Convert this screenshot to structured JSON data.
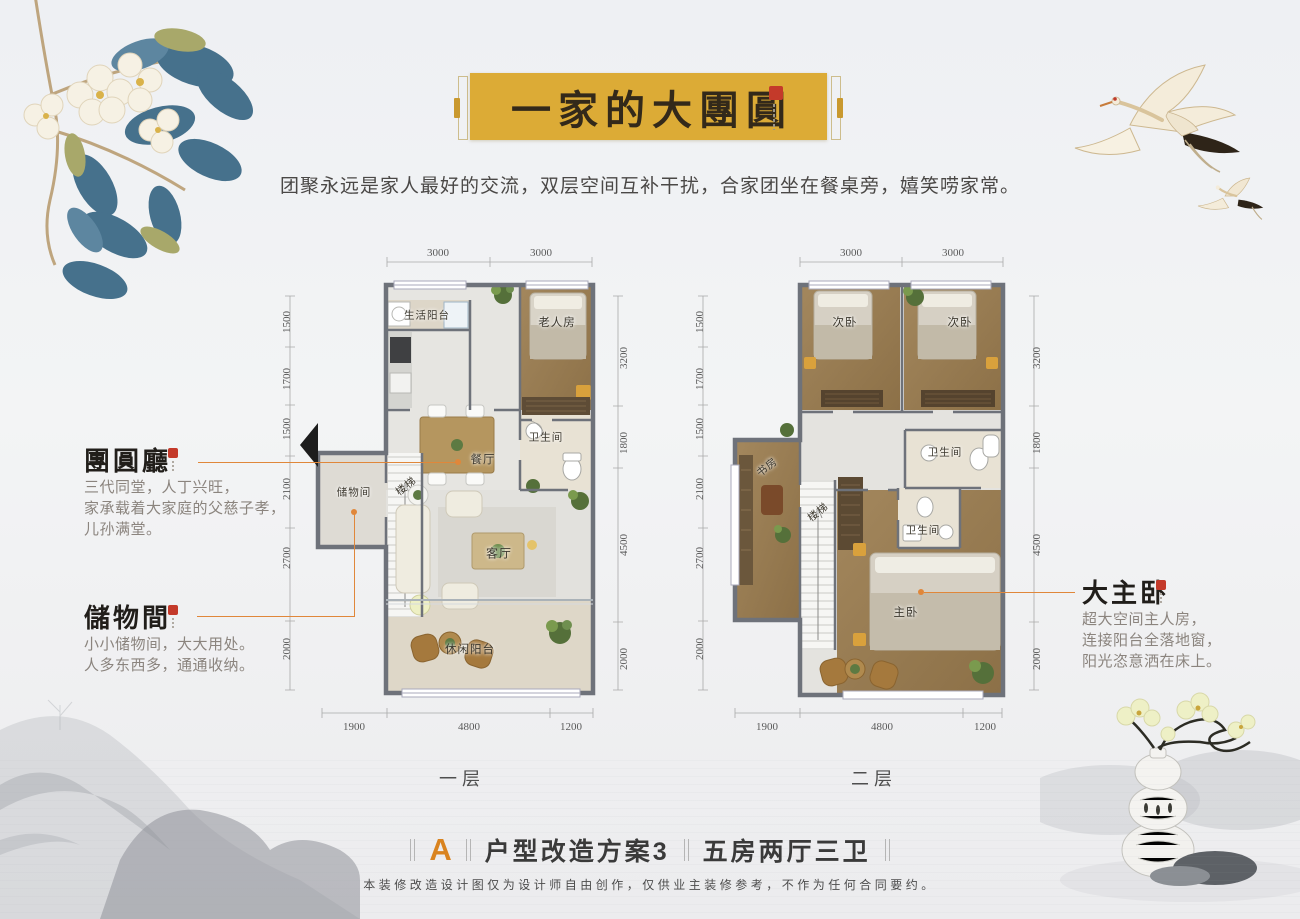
{
  "header": {
    "banner_title": "一家的大團圓",
    "subtitle": "团聚永远是家人最好的交流，双层空间互补干扰，合家团坐在餐桌旁，嬉笑唠家常。"
  },
  "annotations": {
    "reunion_hall": {
      "title": "團圓廳",
      "line1": "三代同堂，人丁兴旺，",
      "line2": "家承载着大家庭的父慈子孝，",
      "line3": "儿孙满堂。"
    },
    "storage_room": {
      "title": "儲物間",
      "line1": "小小储物间，大大用处。",
      "line2": "人多东西多，通通收纳。"
    },
    "master_bedroom": {
      "title": "大主卧",
      "line1": "超大空间主人房，",
      "line2": "连接阳台全落地窗，",
      "line3": "阳光恣意洒在床上。"
    }
  },
  "floor1": {
    "label": "一层",
    "rooms": {
      "life_balcony": "生活阳台",
      "elder_room": "老人房",
      "bathroom": "卫生间",
      "dining": "餐厅",
      "storage": "储物间",
      "stairs": "楼梯",
      "living": "客厅",
      "leisure_balcony": "休闲阳台"
    },
    "dims": {
      "top": [
        "3000",
        "3000"
      ],
      "left": [
        "1500",
        "1700",
        "1500",
        "2100",
        "2700",
        "2000"
      ],
      "right": [
        "3200",
        "1800",
        "4500",
        "2000"
      ],
      "bottom": [
        "1900",
        "4800",
        "1200"
      ]
    }
  },
  "floor2": {
    "label": "二层",
    "rooms": {
      "bedroom_a": "次卧",
      "bedroom_b": "次卧",
      "study": "书房",
      "stairs": "楼梯",
      "bath_upper": "卫生间",
      "bath_lower": "卫生间",
      "master": "主卧"
    },
    "dims": {
      "top": [
        "3000",
        "3000"
      ],
      "left": [
        "1500",
        "1700",
        "1500",
        "2100",
        "2700",
        "2000"
      ],
      "right": [
        "3200",
        "1800",
        "4500",
        "2000"
      ],
      "bottom": [
        "1900",
        "4800",
        "1200"
      ]
    }
  },
  "footer": {
    "scheme_letter": "A",
    "scheme_title": "户型改造方案3",
    "scheme_subtitle": "五房两厅三卫",
    "disclaimer": "本装修改造设计图仅为设计师自由创作，仅供业主装修参考，不作为任何合同要约。"
  },
  "colors": {
    "banner_gold": "#dcab36",
    "accent_orange": "#e0873a",
    "scheme_letter_orange": "#d9831f",
    "wall_grey": "#6e727a",
    "wood_floor": "#9a7e54"
  }
}
